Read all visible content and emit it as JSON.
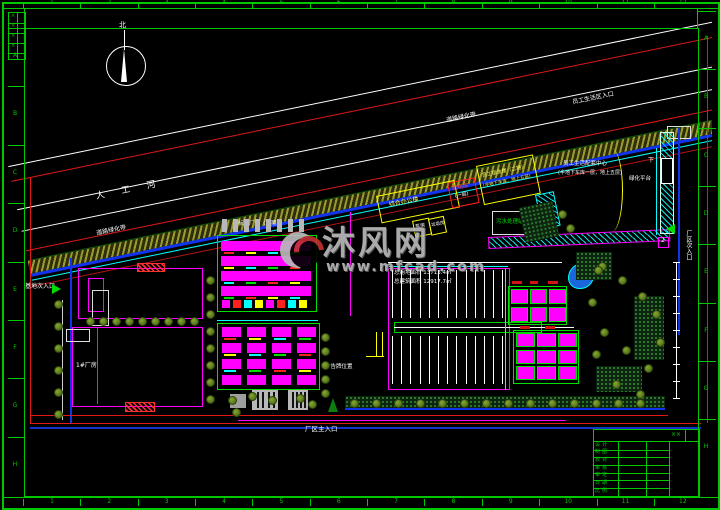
{
  "meta": {
    "title": "厂区总平面布置图 (CAD site plan)",
    "background": "#000000"
  },
  "colors": {
    "frame": "#00c800",
    "magenta": "#ff00ff",
    "green": "#00e000",
    "cyan": "#00ffff",
    "yellow": "#ffff00",
    "red": "#ff2222",
    "blue": "#2244ee",
    "dark_blue": "#1133cc",
    "white": "#ffffff",
    "gray": "#b8b8b8",
    "olive": "#9a9a35",
    "watermark": "#b9b9b9"
  },
  "frame": {
    "top_numbers": [
      "1",
      "2",
      "3",
      "4",
      "5",
      "6",
      "7",
      "8",
      "9",
      "10",
      "11",
      "12"
    ],
    "bottom_numbers": [
      "1",
      "2",
      "3",
      "4",
      "5",
      "6",
      "7",
      "8",
      "9",
      "10",
      "11",
      "12"
    ],
    "left_letters": [
      "A",
      "B",
      "C",
      "D",
      "E",
      "F",
      "G",
      "H"
    ],
    "right_letters": [
      "A",
      "B",
      "C",
      "D",
      "E",
      "F",
      "G",
      "H"
    ],
    "corner_marks": [
      "×",
      "×",
      "×",
      "×"
    ]
  },
  "compass": {
    "north_label": "北"
  },
  "watermark": {
    "brand": "沐风网",
    "url": "www.mfcad.com"
  },
  "labels": {
    "river": "人 工 河",
    "belt_left": "道路绿化带",
    "belt_right": "道路绿化带",
    "staff_entry": "员工生活区入口",
    "side_entry_left": "基地次入口",
    "main_entry": "厂区主入口",
    "side_entry_right": "厂区次入口",
    "billboard": "广告牌位置",
    "down": "下",
    "green_platform": "绿化平台",
    "ramp_num": "2",
    "workshop1": "1#厂房",
    "block_a": "标准厂房（二期）",
    "dorm_line1": "员工宿舍楼（二期）",
    "dorm_line2": "(半地下车库，地上五层)",
    "center_line1": "员工生活配套中心",
    "center_line2": "(半地下车库一层，地上五层)",
    "power1": "配电房",
    "power2": "(一层)",
    "sewage": "污水处理站",
    "office": "综合办公楼",
    "util1": "泵房",
    "util2": "垃圾房",
    "area1": "总用地面积 13713.4㎡",
    "area2": "总建筑面积 12917.7㎡"
  },
  "title_block": {
    "rows": [
      "设计",
      "制图",
      "校对",
      "审核",
      "审定",
      "日期",
      "比例"
    ],
    "stamp": "××"
  },
  "decor": {
    "parking": {
      "stalls_per_row": 13,
      "rows": 2
    },
    "block_a": {
      "bands": 4,
      "roof_bars": 8,
      "bottom_cells": 8
    },
    "block_b": {
      "rows": 4,
      "cols": 4
    },
    "cluster_upper": {
      "rows": 2,
      "cols": 3
    },
    "cluster_lower": {
      "rows": 3,
      "cols": 3
    },
    "trees_bottom_row": 14,
    "trees_workshop_row": 9,
    "trees_col_mid": 8,
    "trees_col_b": 5,
    "trees_left_col": 6,
    "dim_ticks": 9
  }
}
